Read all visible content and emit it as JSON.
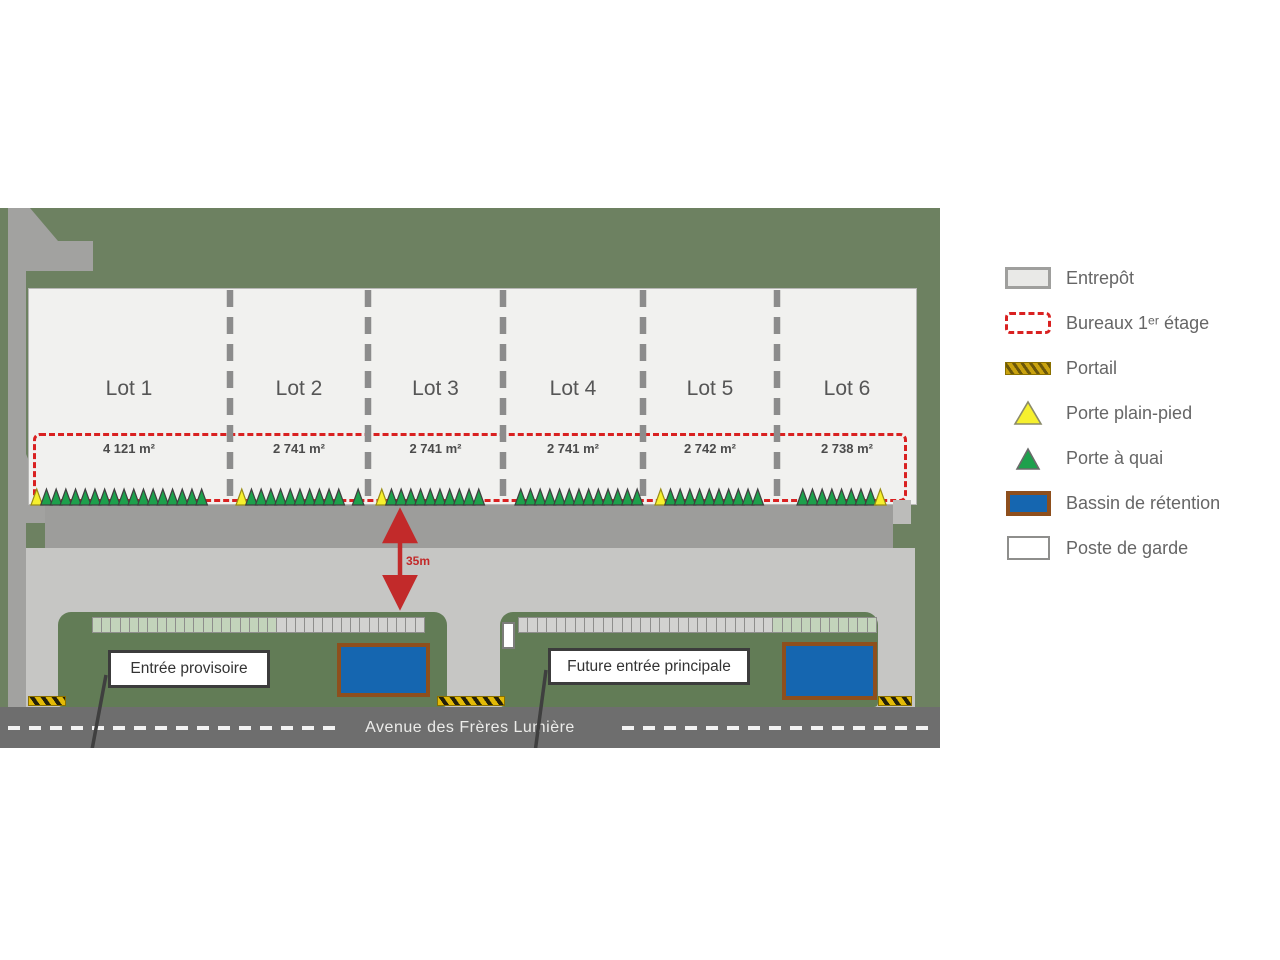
{
  "plan": {
    "road_name": "Avenue des Frères Lumière",
    "distance_label": "35m",
    "entrance_temp_label": "Entrée provisoire",
    "entrance_future_label": "Future entrée principale",
    "lots": [
      {
        "name": "Lot 1",
        "area": "4 121 m²",
        "x": 0,
        "w": 202,
        "door_x": 3,
        "doors": [
          [
            "yellow",
            1
          ],
          [
            "green",
            17
          ]
        ]
      },
      {
        "name": "Lot 2",
        "area": "2 741 m²",
        "x": 202,
        "w": 138,
        "door_x": 6,
        "doors": [
          [
            "yellow",
            1
          ],
          [
            "green",
            10
          ],
          [
            "gap",
            1
          ],
          [
            "green",
            1
          ]
        ]
      },
      {
        "name": "Lot 3",
        "area": "2 741 m²",
        "x": 340,
        "w": 135,
        "door_x": 8,
        "doors": [
          [
            "yellow",
            1
          ],
          [
            "green",
            10
          ]
        ]
      },
      {
        "name": "Lot 4",
        "area": "2 741 m²",
        "x": 475,
        "w": 140,
        "door_x": 12,
        "doors": [
          [
            "green",
            13
          ]
        ]
      },
      {
        "name": "Lot 5",
        "area": "2 742 m²",
        "x": 615,
        "w": 134,
        "door_x": 12,
        "doors": [
          [
            "yellow",
            1
          ],
          [
            "green",
            10
          ]
        ]
      },
      {
        "name": "Lot 6",
        "area": "2 738 m²",
        "x": 749,
        "w": 140,
        "door_x": 20,
        "doors": [
          [
            "green",
            8
          ],
          [
            "yellow",
            1
          ]
        ]
      }
    ],
    "parking_strips": [
      {
        "x": 92,
        "y": 409,
        "w": 333,
        "h": 16,
        "segments": [
          [
            "green",
            20
          ],
          [
            "gray",
            16
          ]
        ]
      },
      {
        "x": 518,
        "y": 409,
        "w": 359,
        "h": 16,
        "segments": [
          [
            "gray",
            27
          ],
          [
            "green",
            11
          ]
        ]
      }
    ],
    "basins": [
      {
        "x": 337,
        "y": 435,
        "w": 93,
        "h": 54
      },
      {
        "x": 782,
        "y": 434,
        "w": 95,
        "h": 58
      }
    ],
    "portals": [
      {
        "x": 28,
        "y": 488,
        "w": 38
      },
      {
        "x": 437,
        "y": 488,
        "w": 68
      },
      {
        "x": 878,
        "y": 488,
        "w": 34
      }
    ],
    "guard_post": {
      "x": 502,
      "y": 414,
      "w": 13,
      "h": 27
    }
  },
  "legend": {
    "items": [
      {
        "label": "Entrepôt",
        "swatch": "entrepot"
      },
      {
        "label": "Bureaux 1ᵉʳ étage",
        "swatch": "bureaux"
      },
      {
        "label": "Portail",
        "swatch": "portail"
      },
      {
        "label": "Porte plain-pied",
        "swatch": "porte-plain-pied"
      },
      {
        "label": "Porte à quai",
        "swatch": "porte-a-quai"
      },
      {
        "label": "Bassin de rétention",
        "swatch": "bassin"
      },
      {
        "label": "Poste de garde",
        "swatch": "poste-de-garde"
      }
    ]
  },
  "colors": {
    "site_green": "#6d8161",
    "island_green": "#627c56",
    "building_fill": "#f1f1ef",
    "divider_gray": "#8c8c8c",
    "red_accent": "#d92121",
    "apron_gray": "#9d9d9b",
    "access_gray": "#a2a2a0",
    "road_light": "#c6c6c4",
    "road_dark": "#6e6e6e",
    "basin_blue": "#1566b0",
    "basin_border": "#8e4f1d",
    "door_green": "#1da04c",
    "door_green_stroke": "#3f3f3f",
    "door_yellow": "#f6f02e",
    "door_yellow_stroke": "#9a8d15",
    "portal_yellow": "#e3ba06",
    "parking_green": "#c3d4bb",
    "parking_gray": "#d2d2d0",
    "arrow_dark": "#3f3f3f"
  }
}
